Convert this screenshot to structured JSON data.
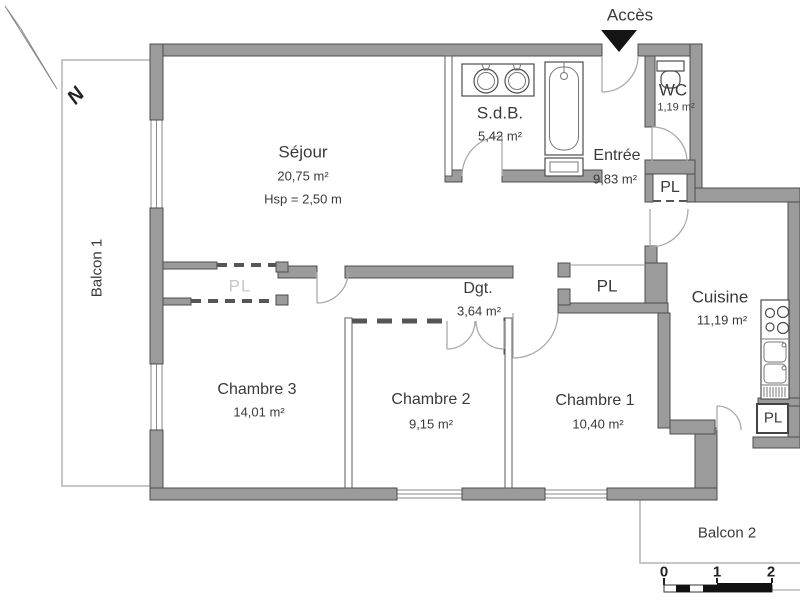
{
  "plan": {
    "compass": {
      "label": "N"
    },
    "access": {
      "label": "Accès"
    },
    "rooms": {
      "sejour": {
        "name": "Séjour",
        "area": "20,75 m²",
        "ceiling": "Hsp = 2,50 m"
      },
      "sdb": {
        "name": "S.d.B.",
        "area": "5,42 m²"
      },
      "wc": {
        "name": "WC",
        "area": "1,19 m²"
      },
      "entree": {
        "name": "Entrée",
        "area": "9,83 m²"
      },
      "cuisine": {
        "name": "Cuisine",
        "area": "11,19 m²"
      },
      "degagement": {
        "name": "Dgt.",
        "area": "3,64 m²"
      },
      "chambre1": {
        "name": "Chambre 1",
        "area": "10,40 m²"
      },
      "chambre2": {
        "name": "Chambre 2",
        "area": "9,15 m²"
      },
      "chambre3": {
        "name": "Chambre 3",
        "area": "14,01 m²"
      },
      "balcon1": {
        "name": "Balcon 1"
      },
      "balcon2": {
        "name": "Balcon 2"
      }
    },
    "closets": {
      "sejour": "PL",
      "entree": "PL",
      "degagement": "PL",
      "cuisine": "PL"
    },
    "scale_bar": {
      "ticks": [
        "0",
        "1",
        "2"
      ]
    },
    "colors": {
      "wall_fill": "#9b9b9b",
      "wall_stroke": "#4d4d4d",
      "balcony_line": "#b4b4b4",
      "label_text": "#3a3a3a",
      "faint_label": "#c8c8c8",
      "access_arrow": "#141414"
    }
  }
}
